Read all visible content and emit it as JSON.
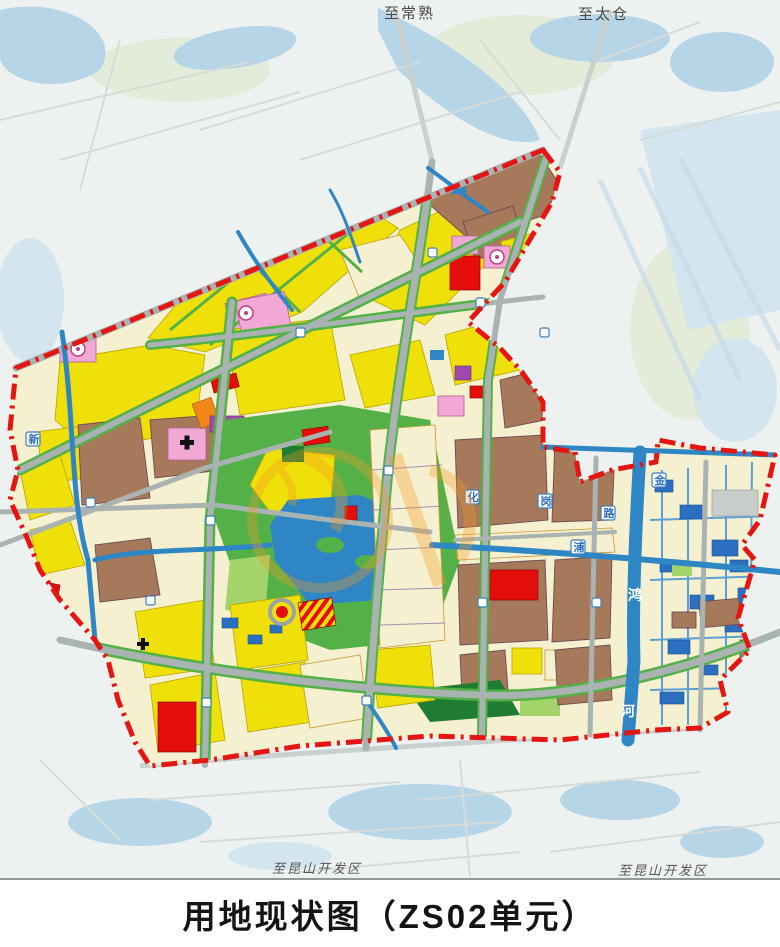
{
  "page": {
    "title": "用地现状图（ZS02单元）"
  },
  "map": {
    "direction_labels": {
      "top_left": {
        "text": "至常熟"
      },
      "top_right": {
        "text": "至太仓"
      },
      "bottom_left": {
        "text": "至昆山开发区"
      },
      "bottom_right": {
        "text": "至昆山开发区"
      }
    },
    "river_labels": {
      "char1": "鸿",
      "char2": "河"
    },
    "road_tags": {
      "t1": "金",
      "t2": "浦",
      "t3": "路",
      "t4": "岗",
      "t5": "新",
      "t6": "化"
    },
    "boundary": {
      "name": "planning-unit-boundary",
      "style": "red dash-dot"
    },
    "palette": {
      "basemap_bg": "#edf2f1",
      "basemap_water": "#b6d6e8",
      "basemap_water_light": "#d3e5ef",
      "road_pale": "#c9d1d0",
      "road_gray": "#a9b3b2",
      "cream": "#f5f0cf",
      "yellow": "#f0e009",
      "brown": "#a6795b",
      "red": "#e60d0d",
      "pink": "#f2a8d4",
      "purple": "#a04ab0",
      "green": "#53b148",
      "green_dark": "#1e7c33",
      "green_light": "#a4d46a",
      "water": "#2e86c4",
      "pond": "#2a6fc0",
      "orange": "#f08718",
      "gray_parcel": "#c9cdc9",
      "boundary_red": "#e41512",
      "watermark_orange": "#f59a23"
    }
  }
}
